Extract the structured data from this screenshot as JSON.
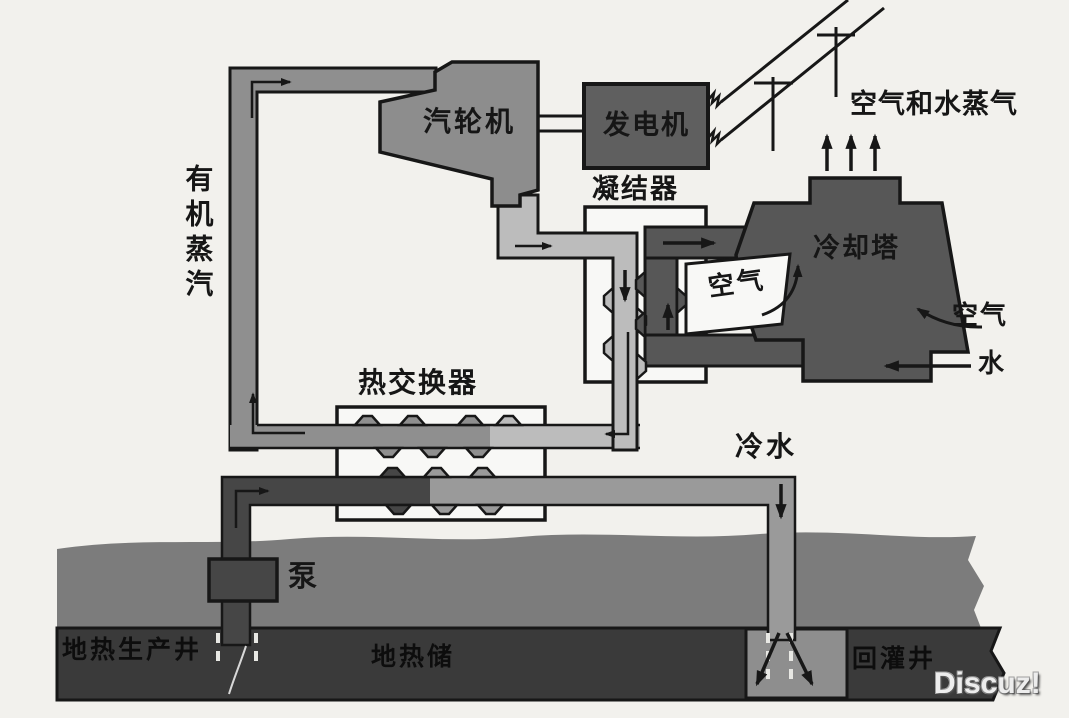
{
  "diagram": {
    "title": "binary-cycle geothermal power plant schematic",
    "labels": {
      "organic_vapor": "有机蒸汽",
      "turbine": "汽轮机",
      "generator": "发电机",
      "condenser": "凝结器",
      "air_and_water_vapor": "空气和水蒸气",
      "cooling_tower": "冷却塔",
      "air_inside": "空气",
      "air_right": "空气",
      "water": "水",
      "heat_exchanger": "热交换器",
      "cold_water": "冷水",
      "pump": "泵",
      "production_well": "地热生产井",
      "geothermal_reservoir": "地热储",
      "injection_well": "回灌井"
    },
    "watermark": "Discuz!",
    "icons": {
      "flow_arrows": "black directional flow arrows",
      "power_line_poles": "T-shaped transmission poles on diagonal wires"
    },
    "colors": {
      "paper": "#f2f1ed",
      "line": "#171717",
      "ink": "#161616",
      "ink-dark": "#0d0d0d",
      "pipe-vapor": "#8f8f8f",
      "pipe-cond": "#bcbcbc",
      "pipe-hot": "#464646",
      "pipe-cool": "#9a9a9a",
      "machine": "#8d8d8d",
      "generator": "#5f5f5f",
      "tower": "#575757",
      "white": "#f8f8f6",
      "ground": "#7c7c7c",
      "rock": "#3a3a3a",
      "zone": "#8e8e8e"
    }
  }
}
